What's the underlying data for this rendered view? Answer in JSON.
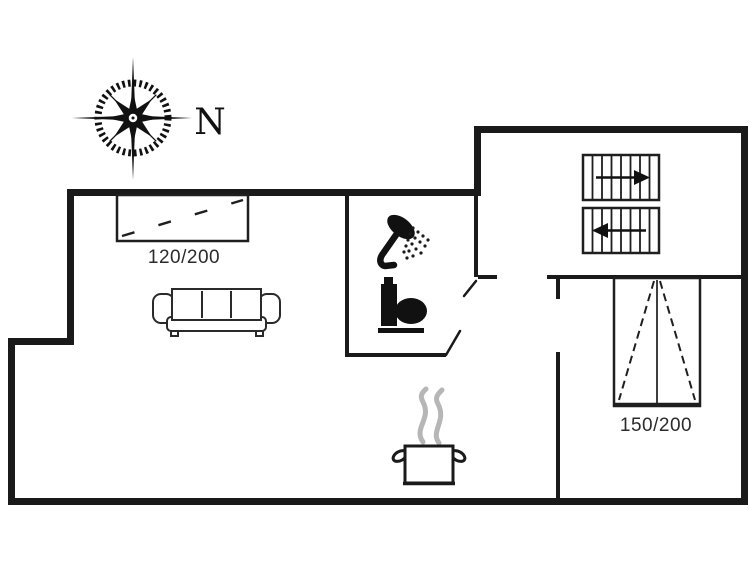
{
  "compass": {
    "label": "N",
    "icon": "compass-rose-icon"
  },
  "labels": {
    "bed_small": "120/200",
    "bed_large": "150/200"
  },
  "icons": [
    "compass-rose-icon",
    "single-bed-icon",
    "sofa-icon",
    "shower-icon",
    "toilet-icon",
    "stairs-up-icon",
    "stairs-down-icon",
    "double-bed-icon",
    "cooking-pot-icon",
    "steam-icon"
  ],
  "colors": {
    "wall": "#1a1a1a",
    "background": "#ffffff",
    "steam": "#b6b6b6",
    "label_text": "#2b2b2b"
  }
}
